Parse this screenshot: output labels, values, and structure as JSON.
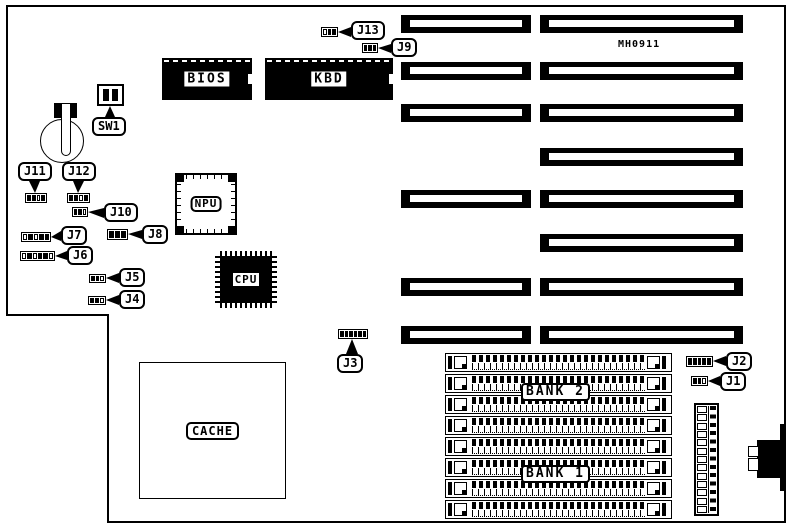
{
  "board": {
    "part_number": "MH0911",
    "chips": {
      "bios": "BIOS",
      "kbd": "KBD",
      "npu": "NPU",
      "cpu": "CPU",
      "cache": "CACHE"
    },
    "switches": {
      "sw1": "SW1"
    },
    "memory_banks": {
      "bank1": "BANK 1",
      "bank2": "BANK 2"
    },
    "jumpers": {
      "j1": "J1",
      "j2": "J2",
      "j3": "J3",
      "j4": "J4",
      "j5": "J5",
      "j6": "J6",
      "j7": "J7",
      "j8": "J8",
      "j9": "J9",
      "j10": "J10",
      "j11": "J11",
      "j12": "J12",
      "j13": "J13"
    }
  }
}
